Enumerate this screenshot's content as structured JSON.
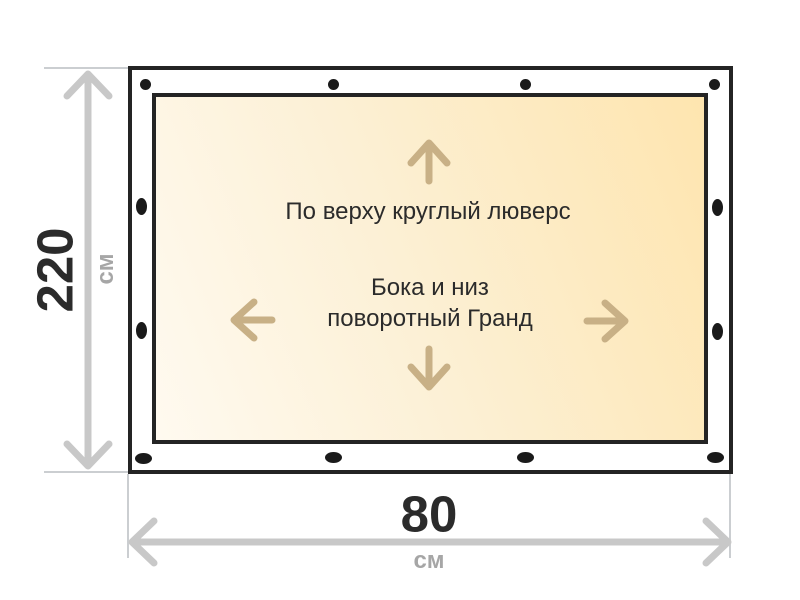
{
  "diagram": {
    "fabric_labels": {
      "top": "По верху круглый люверс",
      "center_line1": "Бока и низ",
      "center_line2": "поворотный Гранд"
    },
    "height_dimension": {
      "value": "220",
      "unit": "см"
    },
    "width_dimension": {
      "value": "80",
      "unit": "см"
    },
    "hardware": {
      "top_edge": "round-grommet",
      "sides_and_bottom": "oval-swivel-grommet",
      "top_count": 4,
      "left_count": 2,
      "right_count": 2,
      "bottom_count": 4
    }
  },
  "icons": {
    "direction_arrows": [
      "up",
      "down",
      "left",
      "right"
    ]
  },
  "colors": {
    "ink": "#2b2b2b",
    "frame": "#242424",
    "grommet": "#1a1a1a",
    "fabric-light": "#fffaf0",
    "fabric-mid": "#fcf0d5",
    "fabric-deep": "#fee5af",
    "arrow-tan": "#c8b086",
    "dim-line": "#c8c8c8",
    "ext-line": "#cbced1",
    "unit-gray": "#a6a6a6"
  }
}
